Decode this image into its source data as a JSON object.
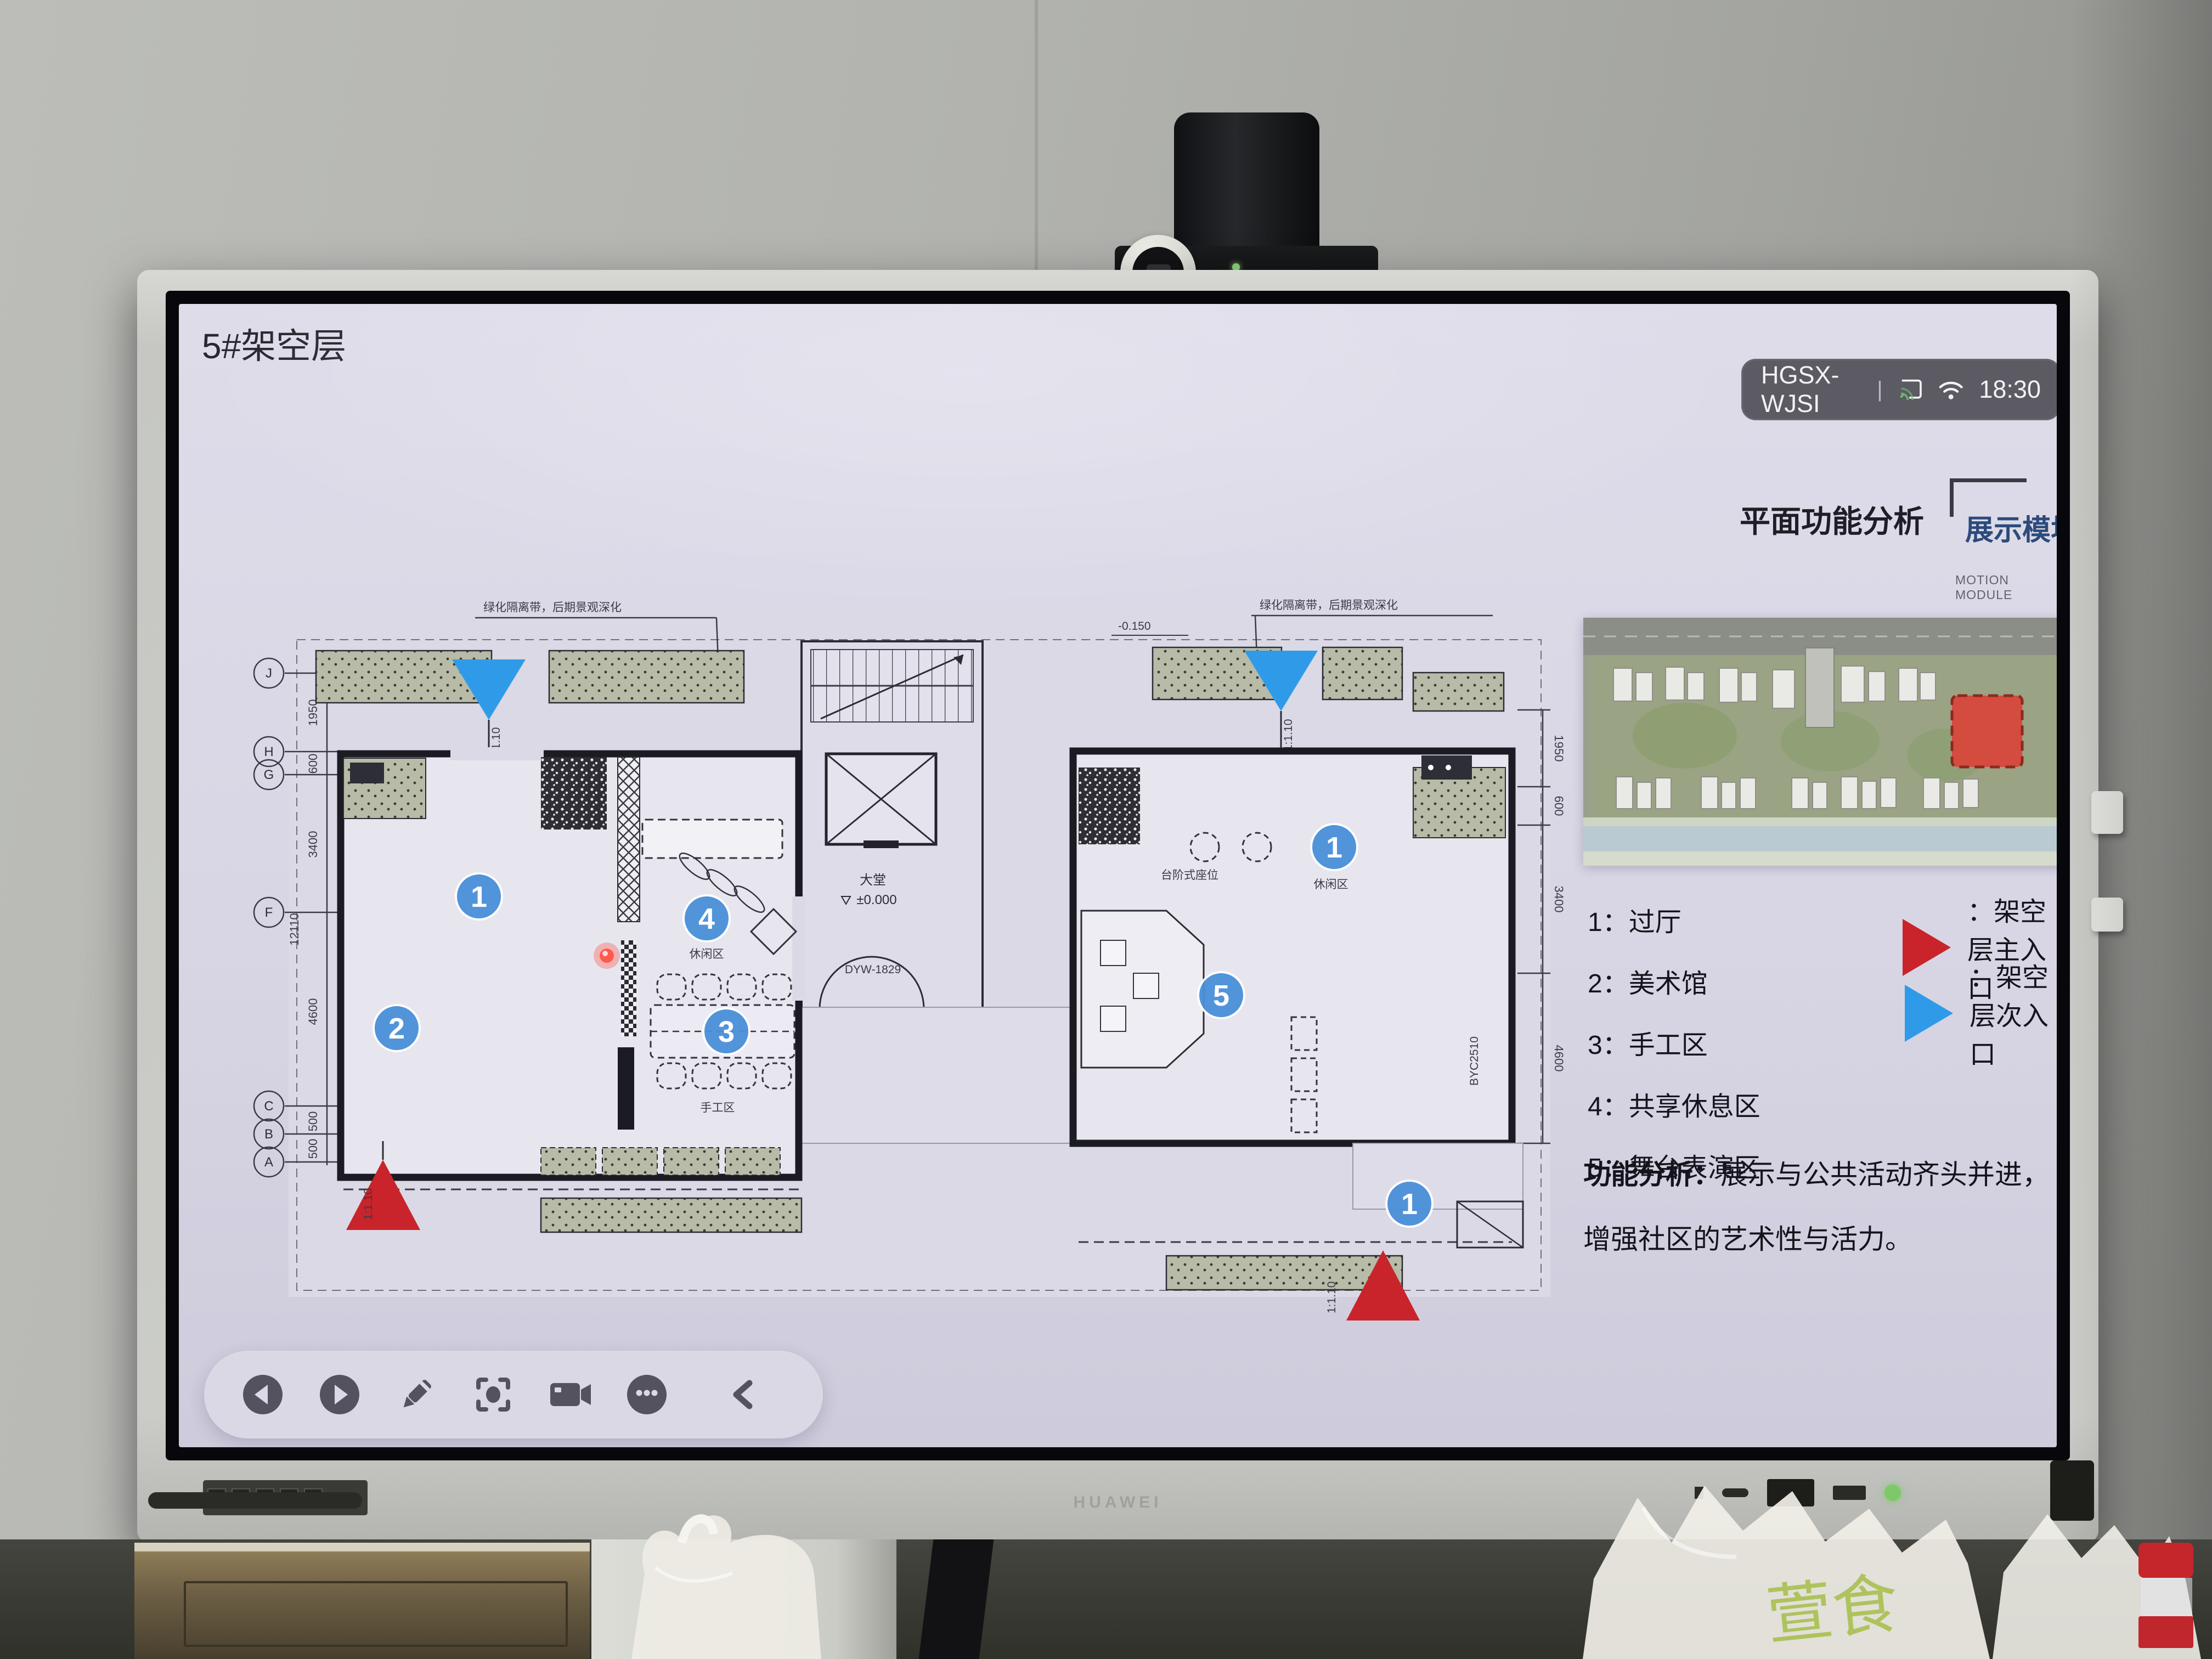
{
  "screen": {
    "title": "5#架空层",
    "status": {
      "device": "HGSX-WJSI",
      "divider": "|",
      "time": "18:30"
    },
    "panel": {
      "heading": "平面功能分析",
      "tag": "展示模块",
      "module_en_1": "MOTION",
      "module_en_2": "MODULE"
    },
    "legend": {
      "items": [
        {
          "text": "1：过厅"
        },
        {
          "text": "2：美术馆"
        },
        {
          "text": "3：手工区"
        },
        {
          "text": "4：共享休息区"
        },
        {
          "text": "5：舞台表演区"
        }
      ]
    },
    "entrances": [
      {
        "label": "：架空层主入口",
        "color": "#c9242b"
      },
      {
        "label": "：架空层次入口",
        "color": "#2f9be8"
      }
    ],
    "analysis": {
      "lead": "功能分析：",
      "line1": "展示与公共活动齐头并进，",
      "line2": "增强社区的艺术性与活力。"
    },
    "toolbar": {
      "icons": [
        "previous",
        "next",
        "pen",
        "screenshot",
        "record",
        "more",
        "collapse"
      ]
    },
    "plan": {
      "markers": {
        "m1": "1",
        "m2": "2",
        "m3": "3",
        "m4": "4",
        "m5": "5"
      },
      "labels": {
        "lounge": "休闲区",
        "craft": "手工区",
        "lobby": "大堂",
        "level_zero": "±0.000",
        "level_minus": "-0.150",
        "door_code": "DYW-1829",
        "seating": "台阶式座位",
        "byc": "BYC2510",
        "green_note": "绿化隔离带，后期景观深化",
        "slope": "1:1.10"
      },
      "grid": {
        "letters": [
          "J",
          "H",
          "G",
          "F",
          "C",
          "B",
          "A"
        ],
        "dims": {
          "d1950": "1950",
          "d600": "600",
          "d3400": "3400",
          "d12110": "12110",
          "d4600": "4600",
          "d500": "500"
        }
      }
    },
    "colors": {
      "marker_blue": "#4a90d9",
      "entrance_red": "#c9242b",
      "entrance_blue": "#2f9be8",
      "tag_blue": "#2c4a7c",
      "site_highlight": "#d9453a"
    }
  },
  "device": {
    "brand": "HUAWEI"
  },
  "environment": {
    "bag_text": "萱食"
  }
}
